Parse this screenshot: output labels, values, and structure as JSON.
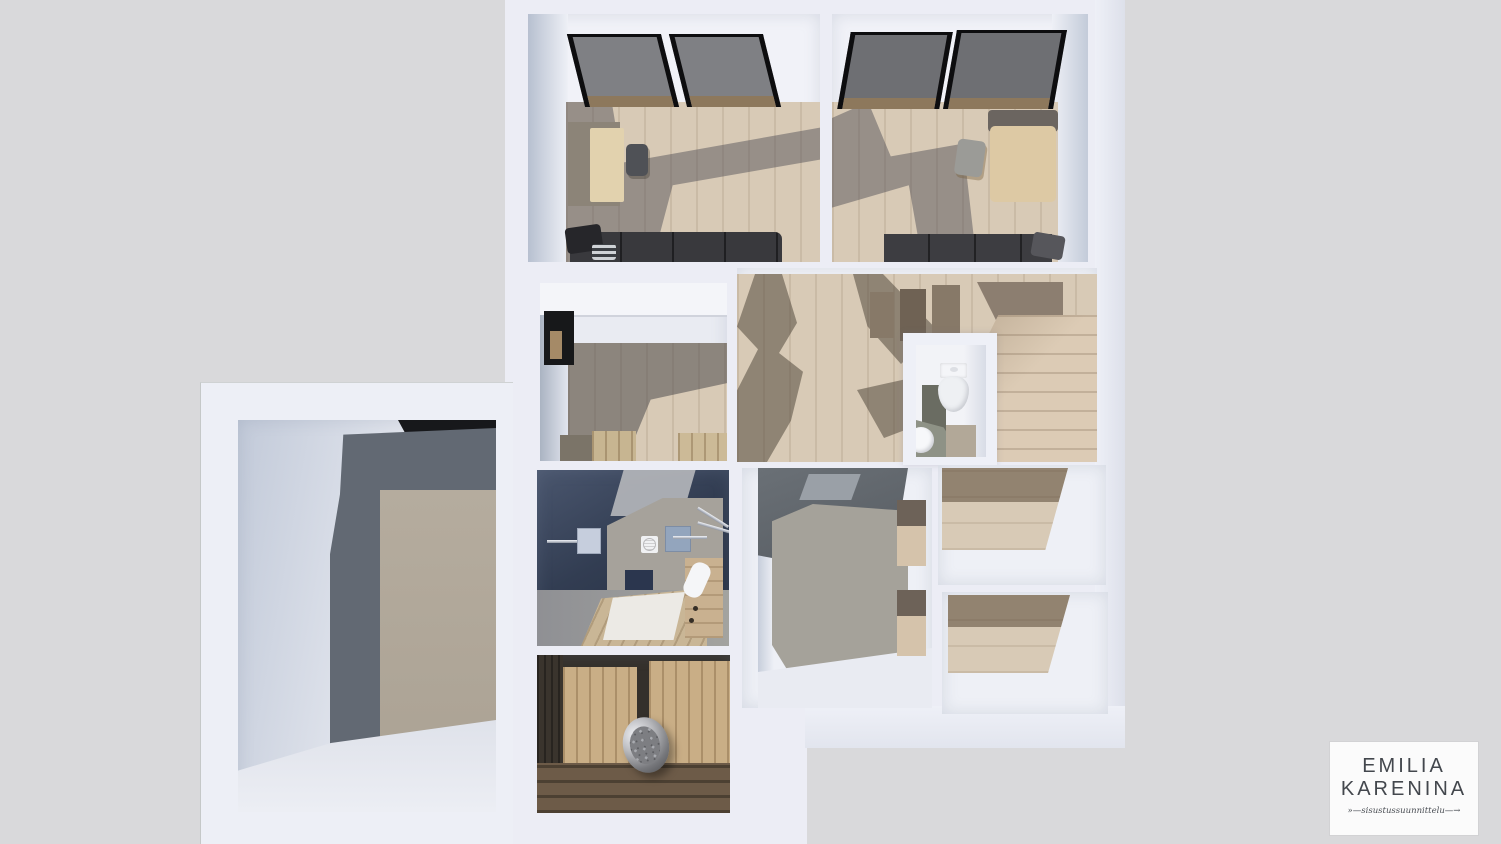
{
  "meta": {
    "content_type": "photorealistic top-down 3D dollhouse render of an apartment floor plan",
    "no_ui_text_except_logo": true
  },
  "palette": {
    "background": "#d9d9db",
    "walls_white": "#edeff6",
    "wood_floor_light": "#d8cab6",
    "wood_dark_shadow": "#7d7468",
    "stair_wood": "#dccbb5",
    "navy_shower_wall": "#323d52",
    "shower_floor_gray": "#9b9b97",
    "sauna_wall_wood": "#c9ae86",
    "sauna_floor_wood": "#6d5b48",
    "heater_steel": "#b9babe",
    "skylight_glass": "#7f8084",
    "skylight_frame": "#0d0d0f",
    "wc_floor": "#8e9286",
    "annex_accent_beige": "#b1a89a"
  },
  "rooms": [
    {
      "id": "bedroom-left",
      "items": [
        "skylight-window",
        "skylight-window",
        "desk",
        "office-chair",
        "sofa-bed",
        "pillows"
      ]
    },
    {
      "id": "bedroom-right",
      "items": [
        "skylight-window",
        "skylight-window",
        "desk",
        "office-chair",
        "bed",
        "pillow"
      ]
    },
    {
      "id": "walk-in-closet",
      "items": [
        "small-window",
        "wardrobe-cabinets"
      ]
    },
    {
      "id": "hallway",
      "items": [
        "staircase-upper-flight",
        "staircase-lower-flight"
      ]
    },
    {
      "id": "wc",
      "items": [
        "toilet",
        "sink",
        "counter"
      ]
    },
    {
      "id": "shower-room",
      "items": [
        "shower-set-left",
        "shower-set-right",
        "vent",
        "duckboard",
        "towel",
        "bench-cabinet"
      ]
    },
    {
      "id": "sauna",
      "items": [
        "sauna-heater-with-stones",
        "wood-panel-walls",
        "slatted-floor"
      ]
    },
    {
      "id": "utility-room",
      "items": []
    },
    {
      "id": "storage-room-upper",
      "items": []
    },
    {
      "id": "storage-room-lower",
      "items": []
    },
    {
      "id": "annex-room",
      "items": [
        "accent-wall-panel"
      ]
    }
  ],
  "logo": {
    "brand_line1": "EMILIA",
    "brand_line2": "KARENINA",
    "tagline": "sisustussuunnittelu",
    "tagline_decorated": "»—sisustussuunnittelu—→",
    "text_color": "#43474d",
    "card_background": "#fbfbfb"
  }
}
